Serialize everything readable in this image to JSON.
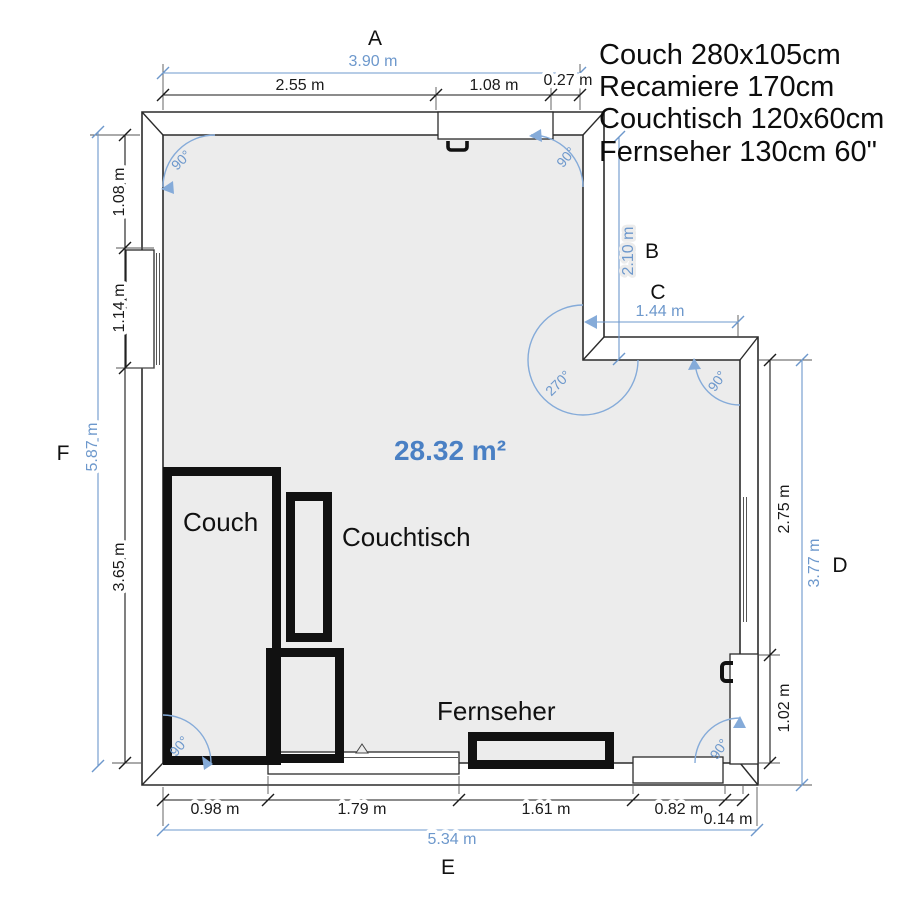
{
  "legend": {
    "lines": [
      "Couch 280x105cm",
      "Recamiere 170cm",
      "Couchtisch 120x60cm",
      "Fernseher 130cm 60\""
    ]
  },
  "area": {
    "label": "28.32 m²"
  },
  "side_labels": {
    "a": "A",
    "b": "B",
    "c": "C",
    "d": "D",
    "e": "E",
    "f": "F"
  },
  "dimensions": {
    "top": {
      "overall": "3.90 m",
      "seg1": "2.55 m",
      "seg2": "1.08 m",
      "seg3": "0.27 m"
    },
    "left": {
      "overall": "5.87 m",
      "seg1": "1.08 m",
      "seg2": "1.14 m",
      "seg3": "3.65 m"
    },
    "right": {
      "overall": "3.77 m",
      "seg1": "2.75 m",
      "seg2": "1.02 m"
    },
    "bottom": {
      "overall": "5.34 m",
      "seg1": "0.98 m",
      "seg2": "1.79 m",
      "seg3": "1.61 m",
      "seg4": "0.82 m",
      "seg5": "0.14 m"
    },
    "notch": {
      "vertical": "2.10 m",
      "horizontal": "1.44 m"
    }
  },
  "angles": {
    "top_left": "90°",
    "top_right": "90°",
    "notch_inner": "270°",
    "notch_outer": "90°",
    "bottom_left": "90°",
    "bottom_right": "90°"
  },
  "furniture": {
    "couch": "Couch",
    "couchtisch": "Couchtisch",
    "fernseher": "Fernseher"
  },
  "colors": {
    "dim_blue": "#6d98cc",
    "area_blue": "#4a80c4",
    "arc_blue": "#85abd9",
    "wall_outline": "#2b2b2b",
    "furniture_outline": "#111111",
    "room_fill": "#ececec"
  }
}
